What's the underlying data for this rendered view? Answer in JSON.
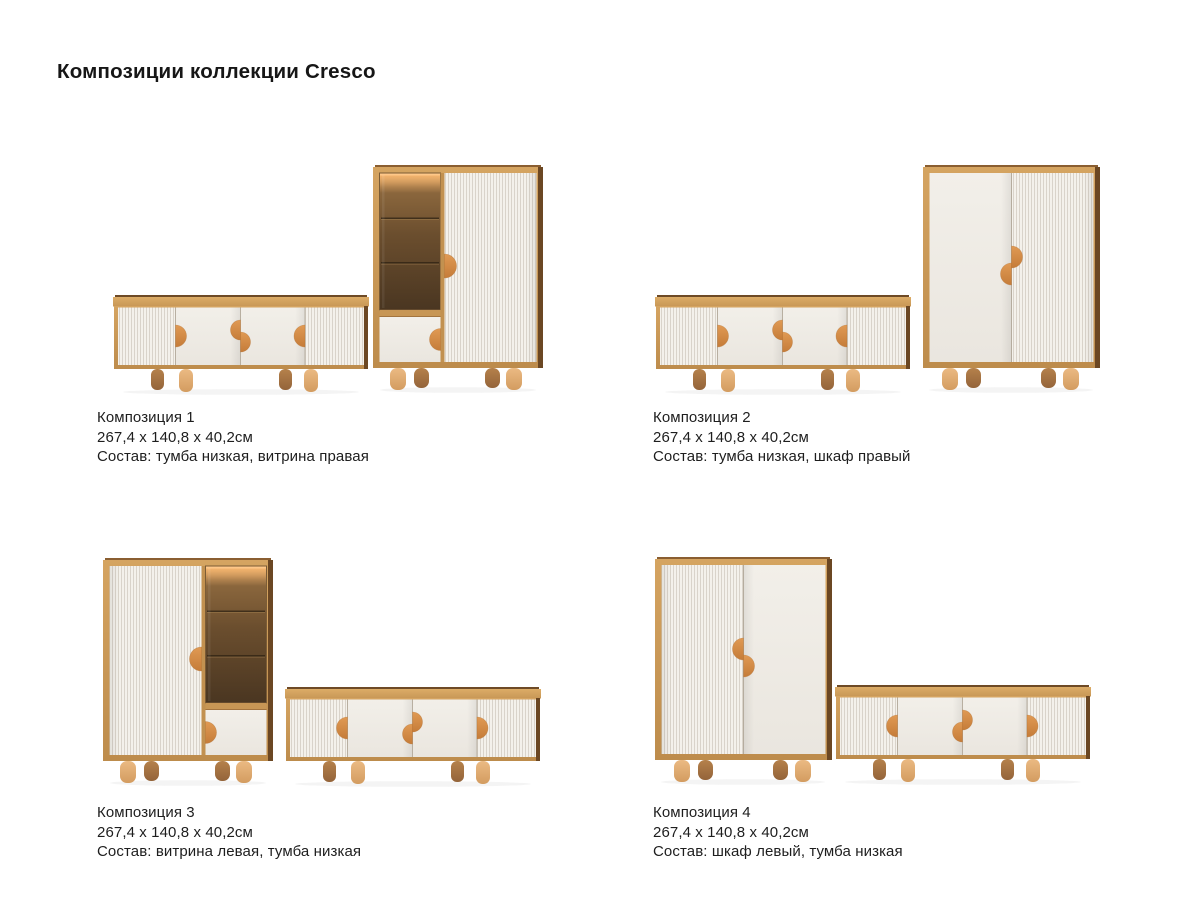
{
  "page": {
    "title": "Композиции коллекции Cresco",
    "background": "#ffffff"
  },
  "collection": "Cresco",
  "compositions": [
    {
      "name": "Композиция 1",
      "dimensions": "267,4 x 140,8 x 40,2см",
      "contents": "Состав: тумба низкая, витрина правая"
    },
    {
      "name": "Композиция 2",
      "dimensions": "267,4 x 140,8 x 40,2см",
      "contents": "Состав: тумба низкая, шкаф правый"
    },
    {
      "name": "Композиция 3",
      "dimensions": "267,4 x 140,8 x 40,2см",
      "contents": "Состав: витрина левая, тумба низкая"
    },
    {
      "name": "Композиция 4",
      "dimensions": "267,4 x 140,8 x 40,2см",
      "contents": "Состав: шкаф левый, тумба низкая"
    }
  ],
  "colors": {
    "background": "#FFFFFF",
    "text": "#1E1E1E",
    "wood": "#CE9D5C",
    "wood_dark_edge": "#6B4723",
    "handle_accent": "#D78E46",
    "fluted_light": "#F4F1EB",
    "fluted_groove": "#D9D3CA",
    "panel_white": "#F0EDE7",
    "glass_interior": "#6B4E2E",
    "glass_glow": "#FFBB72"
  }
}
